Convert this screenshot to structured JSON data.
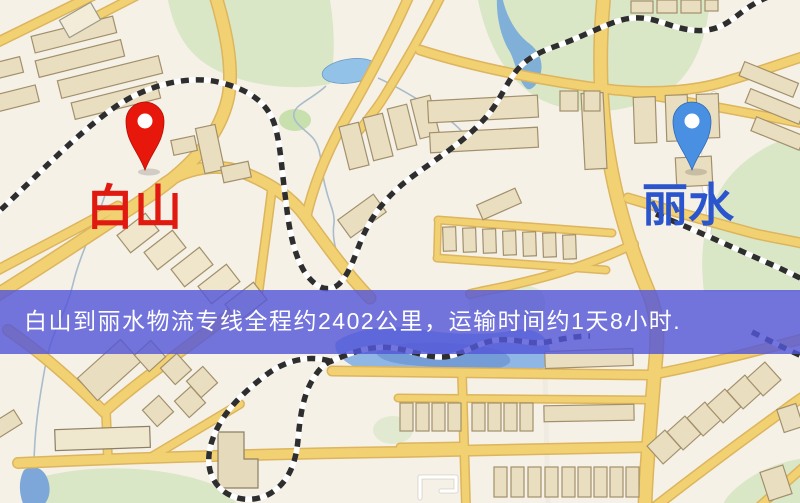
{
  "route": {
    "from": "白山",
    "to": "丽水",
    "distance_km": "2402",
    "duration": "1天8小时"
  },
  "banner": {
    "text": "白山到丽水物流专线全程约2402公里，运输时间约1天8小时.",
    "bg_color": "#5457d8",
    "text_color": "#ffffff"
  },
  "pins": {
    "origin": {
      "label": "白山",
      "pin_color": "#e8170b",
      "label_color": "#e01a10"
    },
    "destination": {
      "label": "丽水",
      "pin_color": "#4a90e2",
      "label_color": "#2b55cc"
    }
  },
  "map": {
    "background_color": "#f6f1e7",
    "road_color": "#f2d173",
    "road_casing_color": "#dcb55e",
    "railway_color": "#2e2e2e",
    "water_color": "#8fb6e4",
    "park_color": "#d9e7c6",
    "building_color": "#eadec0"
  }
}
